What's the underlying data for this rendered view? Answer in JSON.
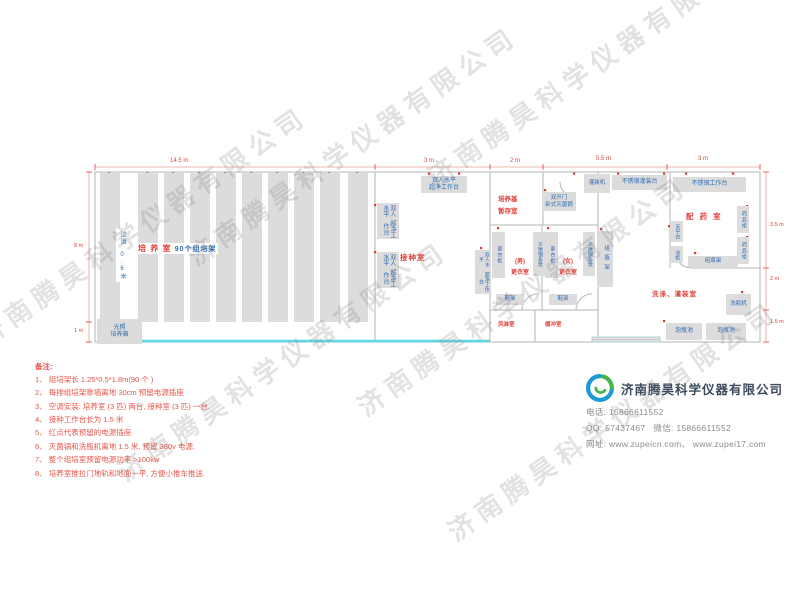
{
  "watermark": {
    "text": "济南腾昊科学仪器有限公司"
  },
  "labels": {
    "culture_room_red": "培 养 室",
    "culture_room_blue": "90个组培架",
    "aisle": "过道 0.6米",
    "incubator_line1": "光照",
    "incubator_line2": "培养箱",
    "inoculation_room": "接种室",
    "clean_bench_line1": "双人水平",
    "clean_bench_line2": "超净工作台",
    "medium_storage_line1": "培养基",
    "medium_storage_line2": "暂存室",
    "sterilizer_line1": "双开门",
    "sterilizer_line2": "卧式灭菌锅",
    "wardrobe": "更衣柜",
    "ss_bench": "不锈钢条凳",
    "male_line1": "(男)",
    "male_line2": "更衣室",
    "female_line1": "(女)",
    "female_line2": "更衣室",
    "shoe_rack": "鞋架",
    "air_shower": "风淋室",
    "buffer_room": "缓冲室",
    "bottle_rack": "组瓶架",
    "filling_machine": "灌装机",
    "ss_filling_table": "不锈钢灌装台",
    "ss_worktable": "不锈钢工作台",
    "dispensing_room": "配 药 室",
    "medicine_cabinet": "药品柜",
    "balance_table": "天平台",
    "freezer": "冰柜",
    "washing_room": "洗涤、灌装室",
    "bottle_washer": "洗瓶机",
    "soak_pool": "泡瓶池"
  },
  "dims": {
    "top": [
      "14.5 m",
      "3 m",
      "2 m",
      "5.5 m",
      "3 m"
    ],
    "right": [
      "3.5 m",
      "2 m",
      "1.5 m"
    ],
    "left": [
      "8 m",
      "1 m"
    ]
  },
  "notes": {
    "title": "备注:",
    "items": [
      "1、 组培架长 1.25*0.5*1.8m(90 个 )",
      "2、 每排组培架靠墙离地 30cm 预留电源插座",
      "3、 空调安装: 培养室 (3 匹) 两台, 接种室 (3 匹) 一台.",
      "4、 接种工作台长为 1.5 米",
      "5、 红点代表预留的电源插座",
      "6、 灭菌锅和洗瓶机离地 1.5 米, 预留 380v 电源.",
      "7、 整个组培室预留电源功率 >100kw",
      "8、 培养室推拉门地轨和地面一平, 方便小推车推送."
    ]
  },
  "company": {
    "name": "济南腾昊科学仪器有限公司",
    "phone_label": "电话:",
    "phone": "15866611552",
    "qq_label": "QQ:",
    "qq": "57437467",
    "wechat_label": "微信:",
    "wechat": "15866611552",
    "web_label": "网址:",
    "websites": "www.zupeicn.com、 www.zupei17.com"
  }
}
